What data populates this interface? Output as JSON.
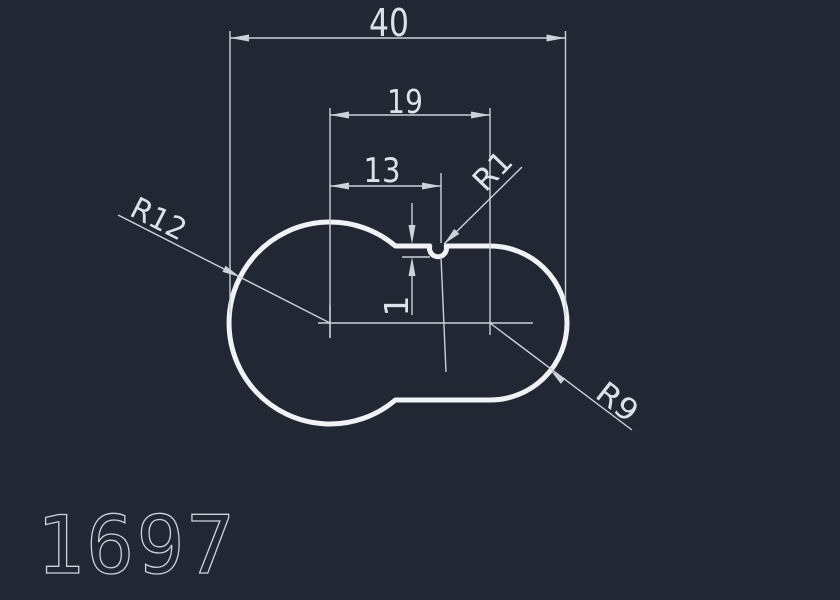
{
  "app": {
    "type": "cad-drawing-view",
    "background_color": "#212733",
    "outline_color": "#f0f2f5",
    "dimension_color": "#ccd2da"
  },
  "drawing": {
    "part_number": "1697",
    "dims": {
      "overall_width": "40",
      "centers_distance": "19",
      "notch_offset": "13",
      "notch_depth": "1",
      "notch_radius": "R1",
      "left_radius": "R12",
      "right_radius": "R9"
    }
  }
}
